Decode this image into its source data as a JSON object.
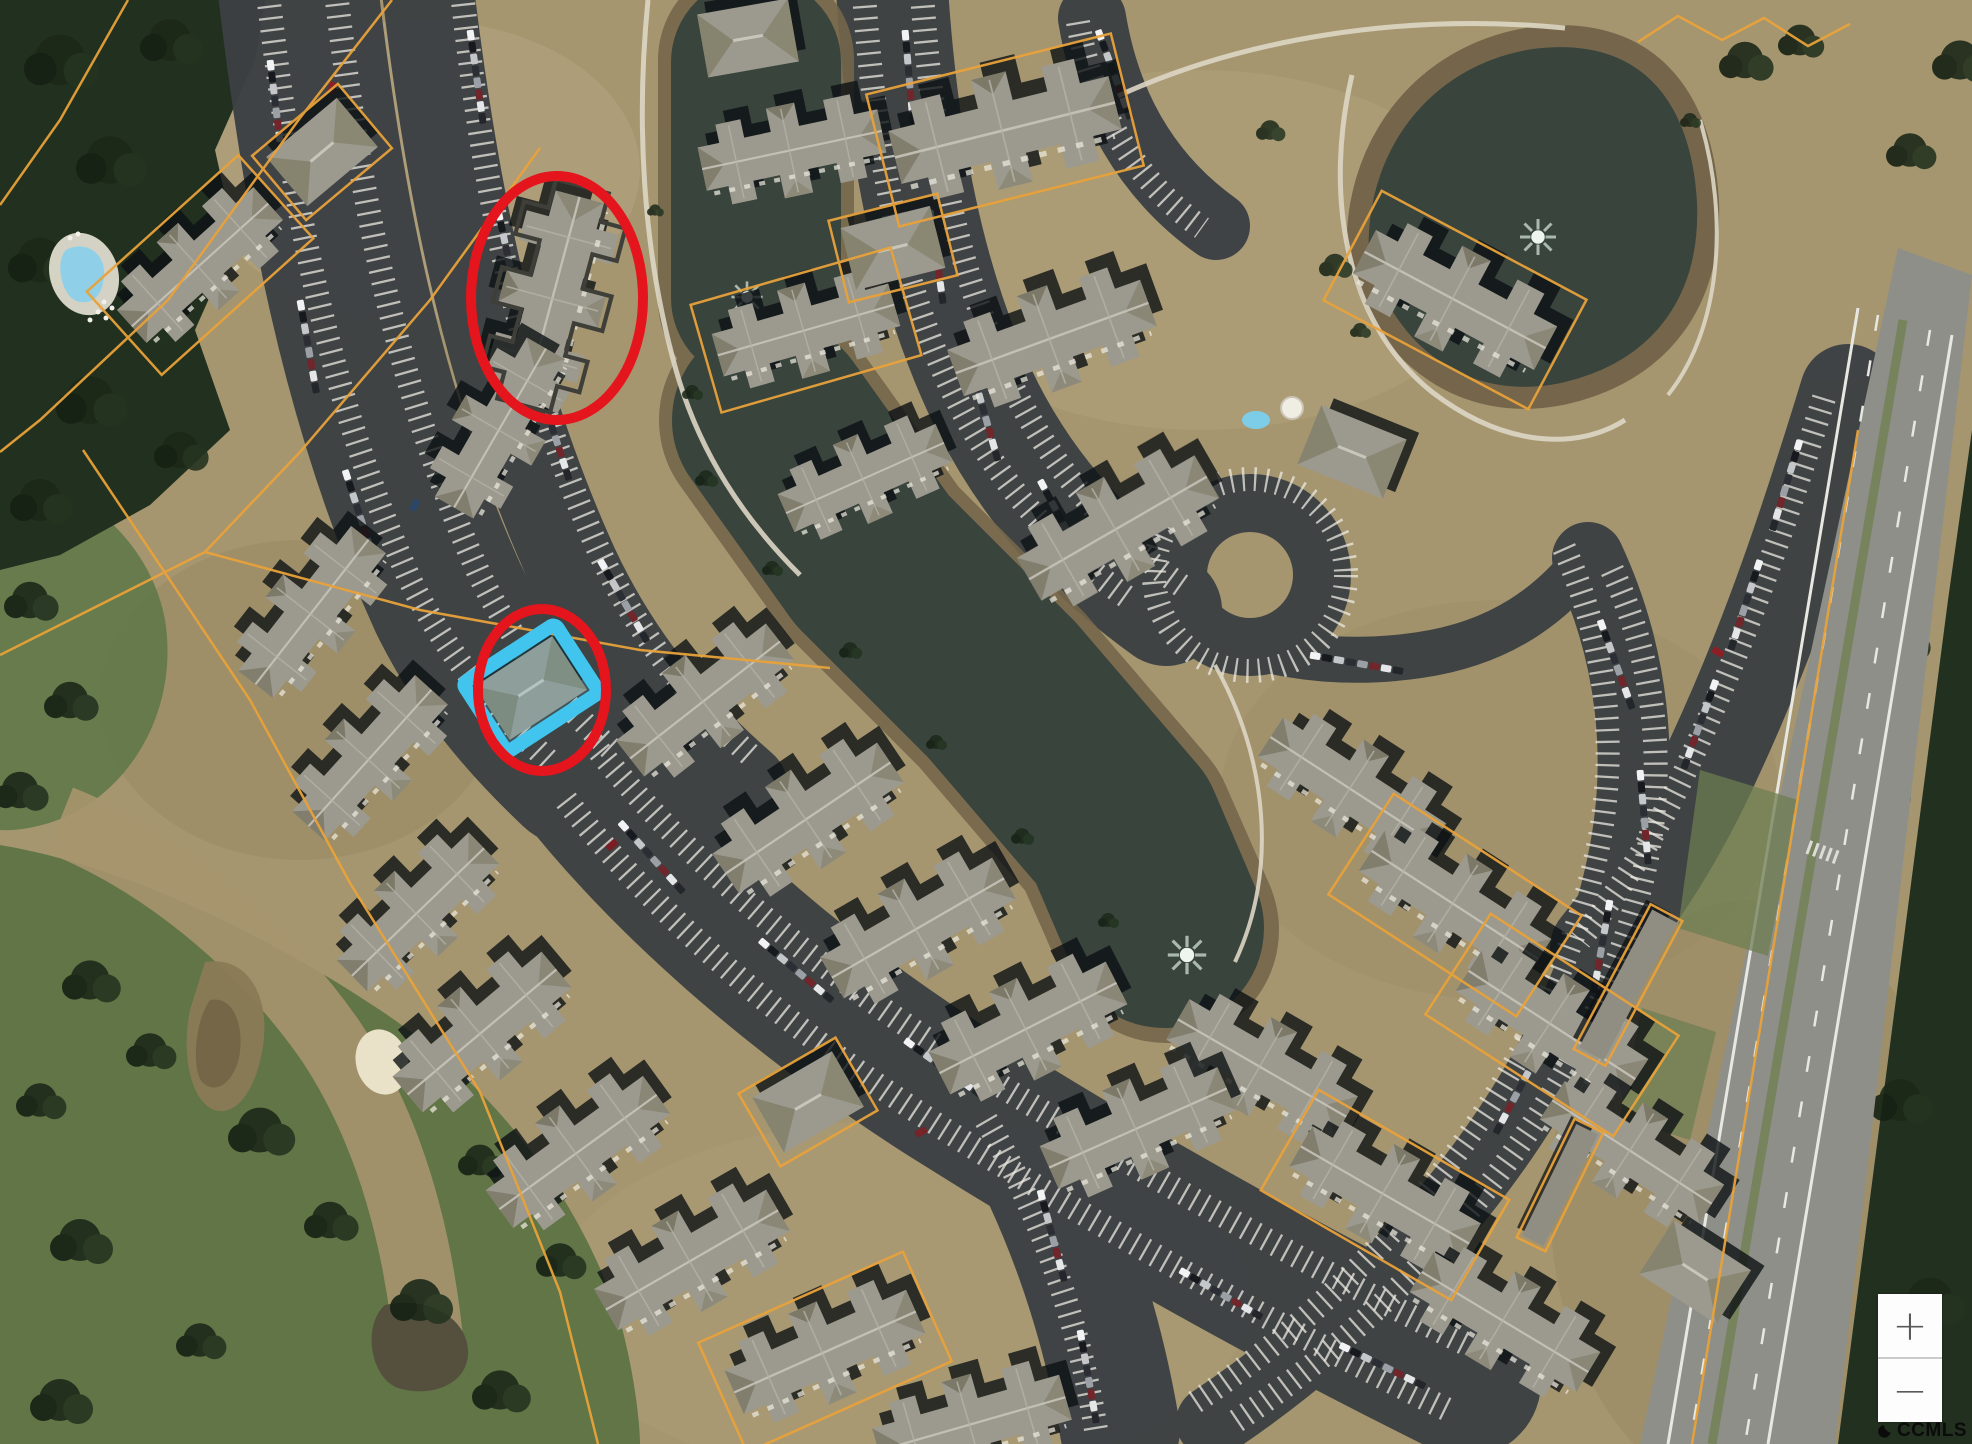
{
  "map": {
    "watermark": {
      "text": "CCMLS",
      "icon": "crescent-wave-icon"
    },
    "zoom_control": {
      "zoom_in_label": "+",
      "zoom_out_label": "−"
    },
    "annotations": {
      "circle_color": "#e4151c",
      "subject_parcel_color": "#41c4ed",
      "parcel_line_color": "#e8a23a",
      "items": [
        {
          "name": "upper-highlight-circle",
          "shape": "ellipse"
        },
        {
          "name": "lower-highlight-circle",
          "shape": "ellipse"
        },
        {
          "name": "subject-parcel-highlight",
          "shape": "rectangle"
        }
      ]
    },
    "palette": {
      "ground": "#a6966f",
      "water": "#39443d",
      "fairway": "#63794a",
      "forest": "#22301f",
      "asphalt": "#3c4044",
      "roof": "#9c998e",
      "highway": "#8f8f89"
    }
  }
}
